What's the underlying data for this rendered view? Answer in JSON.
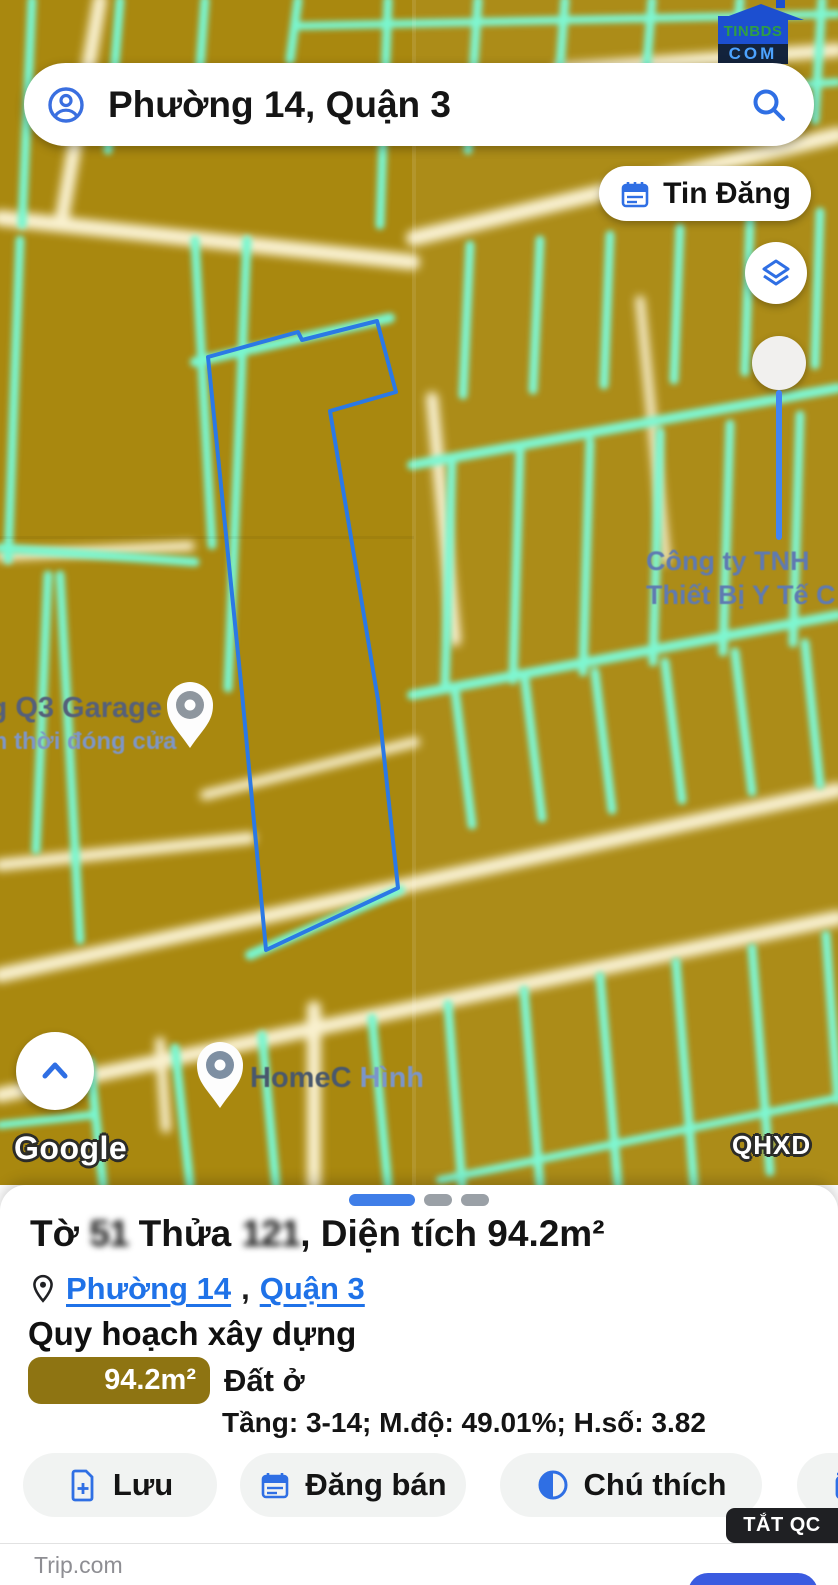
{
  "colors": {
    "mustard": "#a9880f",
    "teal": "#79f7d0",
    "cream": "#f9f1cf",
    "parcel_outline": "#2b79e5",
    "accent_blue": "#2f6fe4",
    "link_blue": "#1f72e8",
    "swatch_olive": "#8e7412",
    "slider_blue": "#4285f4"
  },
  "logo": {
    "line1": "TINBDS",
    "line2": "COM"
  },
  "search": {
    "query": "Phường 14, Quận 3"
  },
  "map": {
    "tin_dang_label": "Tin Đăng",
    "labels": {
      "garage": "ng Q3 Garage",
      "garage_sub": "m thời đóng cửa",
      "company_line1": "Công ty TNH",
      "company_line2": "Thiết Bị Y Tế C",
      "home_part1": "HomeC",
      "home_part2": " Hình",
      "google": "Google",
      "qhxd": "QHXD"
    }
  },
  "sheet": {
    "title": {
      "p1": "Tờ ",
      "to_obscured": "51",
      "p2": " Thửa ",
      "thua_obscured": "121",
      "p3": ", Diện tích 94.2m²"
    },
    "location": {
      "ward": "Phường 14",
      "comma": ",",
      "district": "Quận 3"
    },
    "section_heading": "Quy hoạch xây dựng",
    "zone": {
      "area": "94.2m²",
      "type": "Đất ở",
      "detail": "Tầng: 3-14; M.độ: 49.01%; H.số: 3.82"
    },
    "actions": {
      "save": "Lưu",
      "sell": "Đăng bán",
      "legend": "Chú thích"
    }
  },
  "ad": {
    "close": "TẮT QC",
    "brand": "Trip.com"
  }
}
